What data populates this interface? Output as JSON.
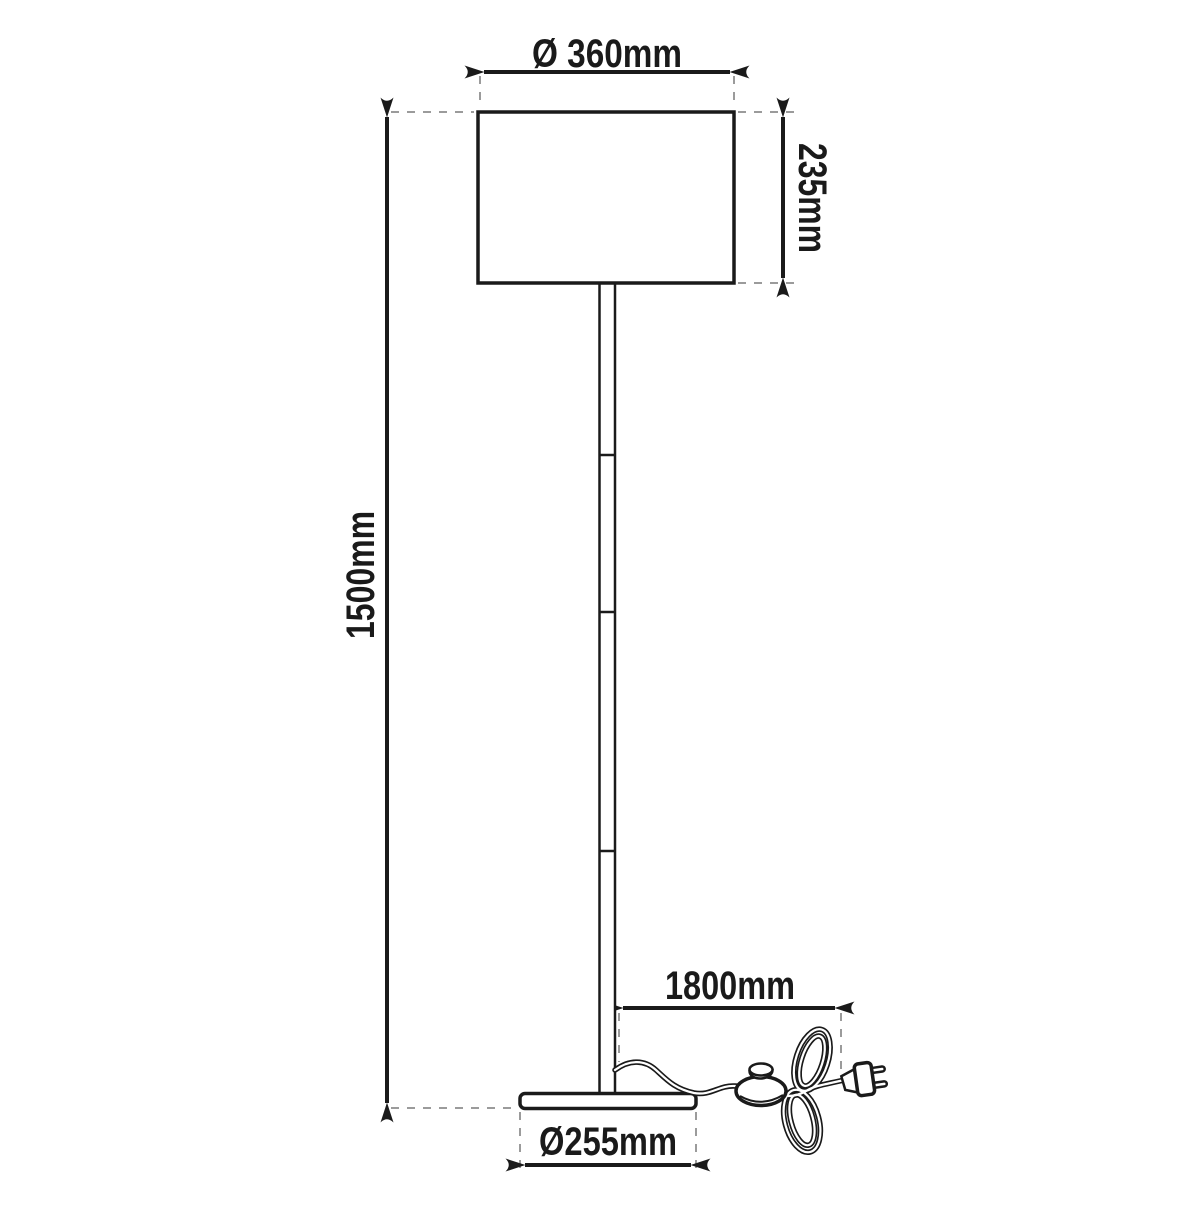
{
  "dimensions": {
    "shade_diameter": "Ø 360mm",
    "shade_height": "235mm",
    "lamp_height": "1500mm",
    "cable_length": "1800mm",
    "base_diameter": "Ø255mm"
  },
  "colors": {
    "line": "#1a1a1a",
    "dashed_line": "#9b9b9b",
    "background": "#ffffff"
  }
}
